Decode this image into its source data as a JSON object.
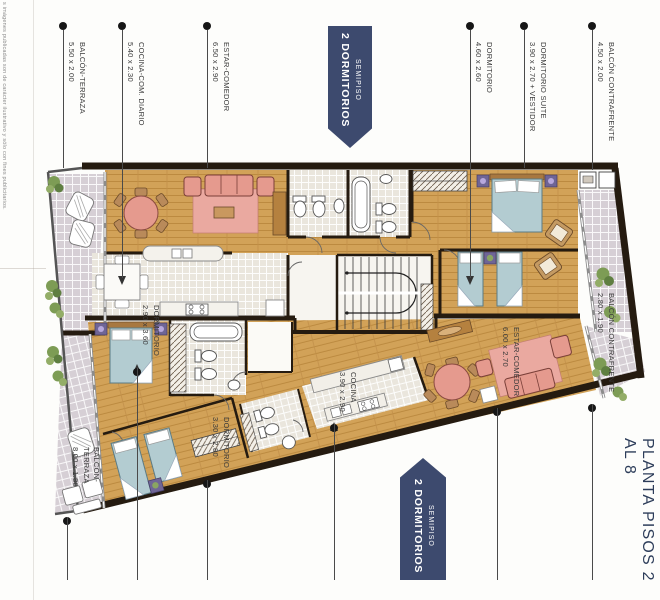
{
  "disclaimer": "s imágenes publicadas son de carácter ilustrativo y sólo con fines publicitarios.",
  "title": "PLANTA PISOS 2 AL 8",
  "banner_top": {
    "line1": "SEMIPISO",
    "line2": "2 DORMITORIOS"
  },
  "banner_bottom": {
    "line1": "SEMIPISO",
    "line2": "2 DORMITORIOS"
  },
  "callouts_top": [
    {
      "name": "BALCÓN-TERRAZA",
      "dim": "5.50 x 2.00"
    },
    {
      "name": "COCINA-COM. DIARIO",
      "dim": "5.40 x 2.30"
    },
    {
      "name": "ESTAR-COMEDOR",
      "dim": "6.50 x 2.90"
    },
    {
      "name": "DORMITORIO",
      "dim": "4.60 x 2.60"
    },
    {
      "name": "DORMITORIO SUITE",
      "dim": "3.90 x 2.70 + VESTIDOR"
    },
    {
      "name": "BALCÓN CONTRAFRENTE",
      "dim": "4.50 x 2.00"
    }
  ],
  "callouts_bottom": [
    {
      "name": "BALCÓN-TERRAZA",
      "dim": "8.00 x 1.80"
    },
    {
      "name": "DORMITORIO",
      "dim": "2.90 x 3.60"
    },
    {
      "name": "DORMITORIO",
      "dim": "3.30 x 2.80"
    },
    {
      "name": "COCINA",
      "dim": "3.90 x 2.90"
    },
    {
      "name": "ESTAR-COMEDOR",
      "dim": "6.00 x 2.70"
    },
    {
      "name": "BALCÓN CONTRAFRENTE",
      "dim": "2.80 x 1.90"
    }
  ],
  "colors": {
    "wood": "#d2a258",
    "wood_dark": "#b9873d",
    "tile": "#d6cfd5",
    "kitchen_tile": "#eae6dd",
    "wall": "#251b10",
    "pink": "#e59a8e",
    "pink_light": "#eaa9a0",
    "blue": "#b3ccd1",
    "banner": "#3d4a6e",
    "title": "#2c3c59",
    "plant": "#7d9c55",
    "label": "#3a3a3a"
  }
}
